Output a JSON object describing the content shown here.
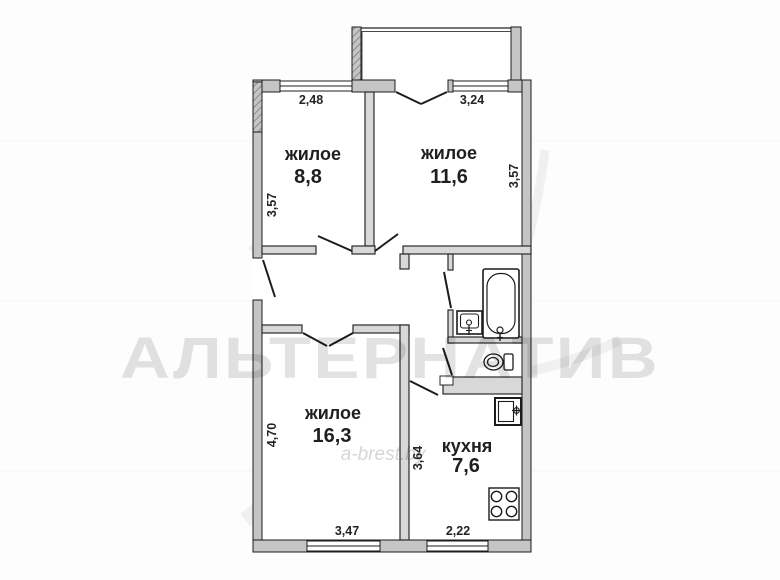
{
  "plan": {
    "type": "apartment-floorplan",
    "rooms": [
      {
        "label": "жилое",
        "area": "8,8"
      },
      {
        "label": "жилое",
        "area": "11,6"
      },
      {
        "label": "жилое",
        "area": "16,3"
      },
      {
        "label": "кухня",
        "area": "7,6"
      }
    ],
    "dims": {
      "room1_width": "2,48",
      "room2_width": "3,24",
      "room1_height": "3,57",
      "room2_height": "3,57",
      "room3_height": "4,70",
      "room3_width": "3,47",
      "kitchen_height": "3,64",
      "kitchen_width": "2,22"
    },
    "watermark": {
      "brand": "АЛЬТЕРНАТИВ",
      "site": "a-brest.by"
    },
    "colors": {
      "exterior_wall_fill": "#c5c5c5",
      "interior_wall_fill": "#d8d8d8",
      "line": "#1c1c1c",
      "floor": "#ffffff"
    }
  }
}
